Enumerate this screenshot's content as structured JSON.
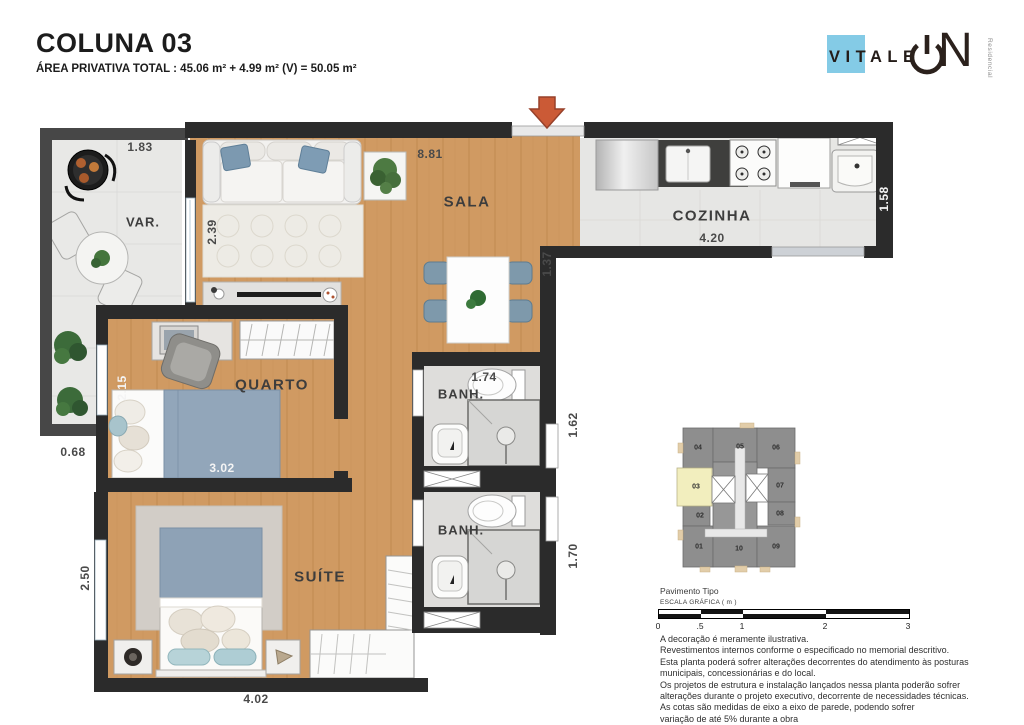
{
  "header": {
    "title": "COLUNA 03",
    "subtitle": "ÁREA PRIVATIVA TOTAL : 45.06 m² + 4.99 m² (V) = 50.05 m²"
  },
  "logo": {
    "brand": "VITALE",
    "letter_n": "N",
    "tagline": "Residencial"
  },
  "colors": {
    "accent_blue": "#84cbe6",
    "wall": "#2b2b2b",
    "wood_floor": "#d09a62",
    "entrance_arrow": "#cb5a36",
    "keyplan_highlight": "#f2eebe"
  },
  "plan": {
    "rooms": {
      "varanda": "VAR.",
      "sala": "SALA",
      "cozinha": "COZINHA",
      "quarto": "QUARTO",
      "banh1": "BANH.",
      "banh2": "BANH.",
      "suite": "SUÍTE"
    },
    "dims": {
      "varanda_top": "1.83",
      "sala_top": "8.81",
      "sala_left": "2.39",
      "sala_right": "1.37",
      "cozinha_width": "4.20",
      "cozinha_right": "1.58",
      "quarto_left": "2.15",
      "quarto_width": "3.02",
      "banh1_top": "1.74",
      "banh1_right": "1.62",
      "banh2_right": "1.70",
      "varanda_bottom": "0.68",
      "suite_left": "2.50",
      "suite_bottom": "4.02"
    }
  },
  "keyplan": {
    "caption": "Pavimento Tipo",
    "highlighted_unit": "03",
    "units": {
      "u01": "01",
      "u02": "02",
      "u03": "03",
      "u04": "04",
      "u05": "05",
      "u06": "06",
      "u07": "07",
      "u08": "08",
      "u09": "09",
      "u10": "10"
    }
  },
  "scalebar": {
    "label": "ESCALA GRÁFICA ( m )",
    "ticks": [
      "0",
      ".5",
      "1",
      "2",
      "3"
    ]
  },
  "disclaimer": {
    "lines": [
      "A decoração é meramente ilustrativa.",
      "Revestimentos internos conforme o especificado no memorial descritivo.",
      "Esta planta poderá sofrer alterações decorrentes do atendimento às posturas",
      "municipais, concessionárias e do local.",
      "Os projetos de estrutura e instalação lançados nessa planta poderão sofrer",
      "alterações durante o projeto executivo, decorrente de necessidades técnicas.",
      "As cotas são medidas de eixo a eixo de parede, podendo sofrer",
      "variação de até 5% durante a obra"
    ]
  }
}
